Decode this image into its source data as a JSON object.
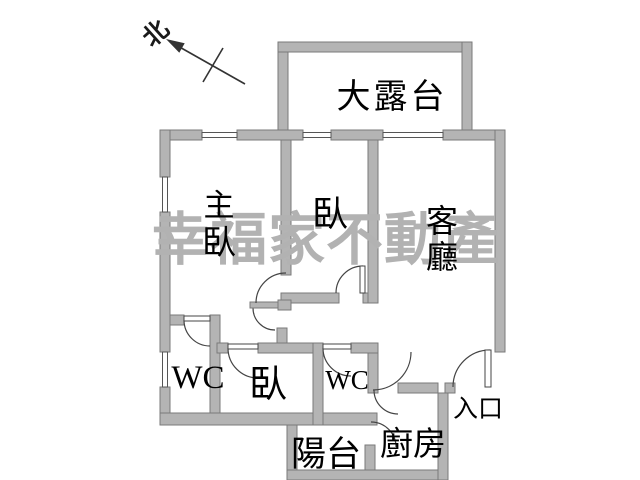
{
  "plan": {
    "compass": {
      "label": "北"
    },
    "watermark": {
      "text": "幸福家不動產",
      "color": "#b2b2b2"
    },
    "rooms": {
      "terrace": {
        "label": "大露台"
      },
      "master_bedroom": {
        "label": "主臥",
        "char1": "主",
        "char2": "臥"
      },
      "bedroom_middle": {
        "label": "臥"
      },
      "living_room": {
        "label": "客廳",
        "char1": "客",
        "char2": "廳"
      },
      "wc_left": {
        "label": "WC"
      },
      "bedroom_lower": {
        "label": "臥"
      },
      "wc_right": {
        "label": "WC"
      },
      "balcony": {
        "label": "陽台"
      },
      "kitchen": {
        "label": "廚房"
      },
      "entrance": {
        "label": "入口"
      }
    },
    "colors": {
      "wall_fill": "#b4b4b4",
      "wall_stroke": "#7a7a7a",
      "line": "#444444",
      "text": "#000000",
      "background": "#ffffff"
    }
  }
}
